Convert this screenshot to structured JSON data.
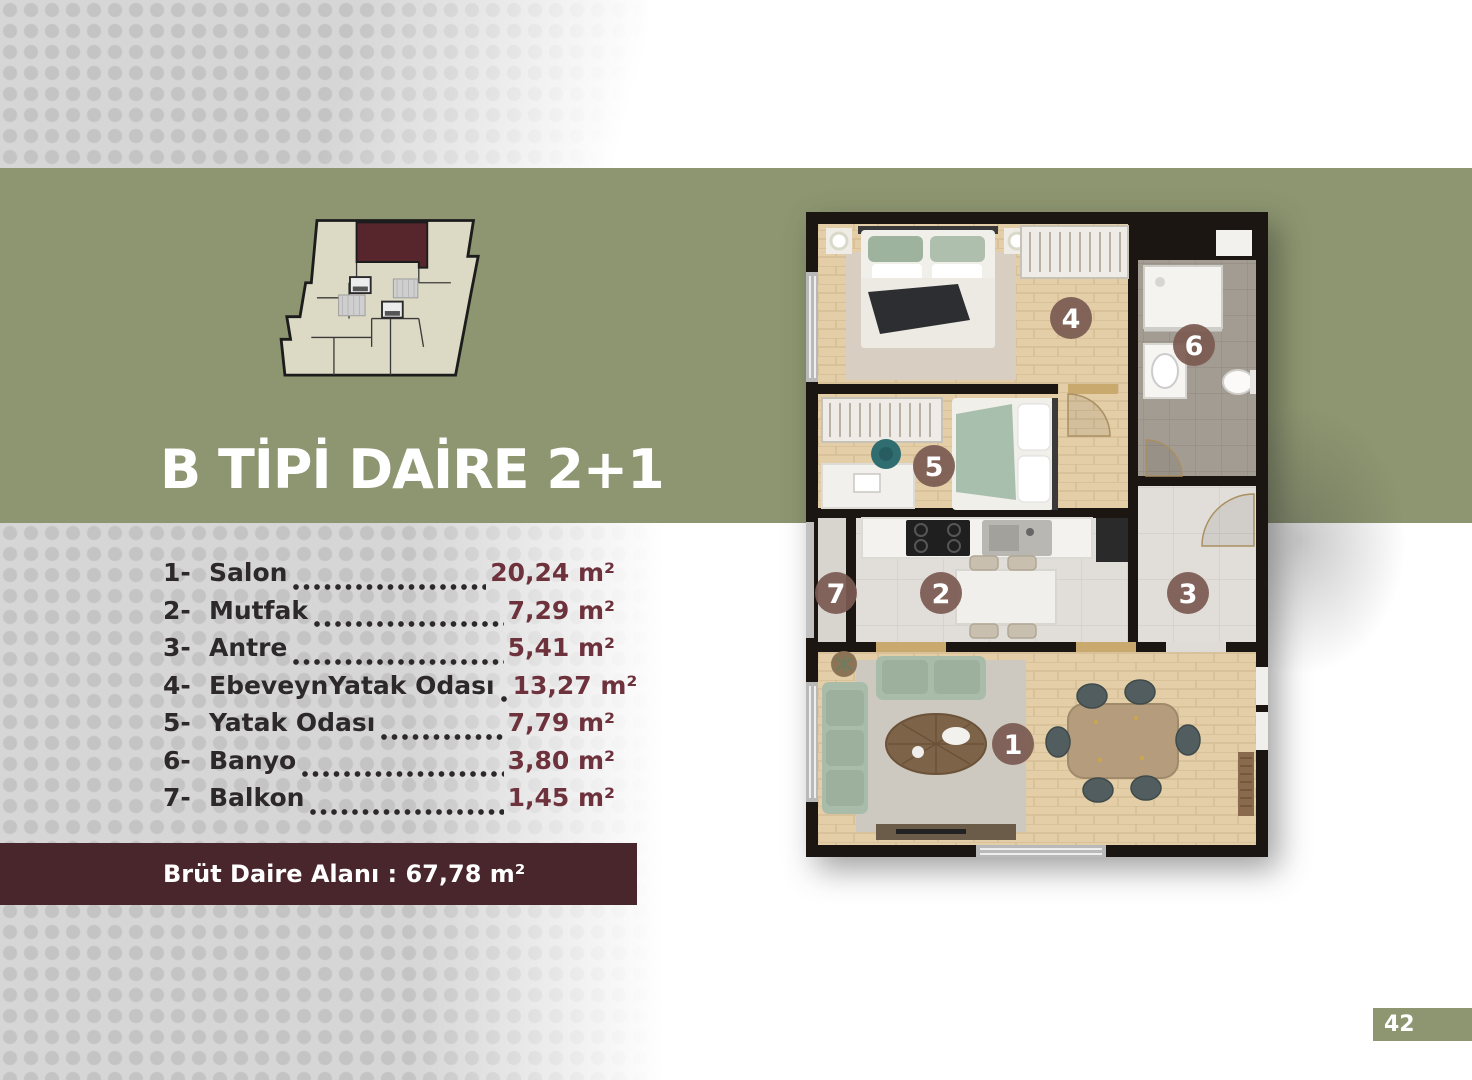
{
  "title": "B TİPİ DAİRE 2+1",
  "room_list": [
    {
      "index": "1-",
      "name": "Salon",
      "area": "20,24 m²"
    },
    {
      "index": "2-",
      "name": "Mutfak",
      "area": "7,29 m²"
    },
    {
      "index": "3-",
      "name": "Antre",
      "area": "5,41 m²"
    },
    {
      "index": "4-",
      "name": "EbeveynYatak Odası",
      "area": "13,27 m²"
    },
    {
      "index": "5-",
      "name": "Yatak Odası",
      "area": "7,79 m²"
    },
    {
      "index": "6-",
      "name": "Banyo",
      "area": "3,80 m²"
    },
    {
      "index": "7-",
      "name": "Balkon",
      "area": "1,45 m²"
    }
  ],
  "banner": {
    "text": "Brüt Daire Alanı : 67,78 m²"
  },
  "plan": {
    "room_markers": [
      "1",
      "2",
      "3",
      "4",
      "5",
      "6",
      "7"
    ]
  },
  "page": {
    "number": "42"
  },
  "colors": {
    "band_green": "#8d9670",
    "banner_maroon": "#48262b",
    "area_value_maroon": "#6e323d",
    "marker_brown": "#7b5a52",
    "keyplan_highlight_unit": "#56262c",
    "keyplan_floor": "#dcd9c4",
    "dots_gray": "#c5c4c4"
  }
}
